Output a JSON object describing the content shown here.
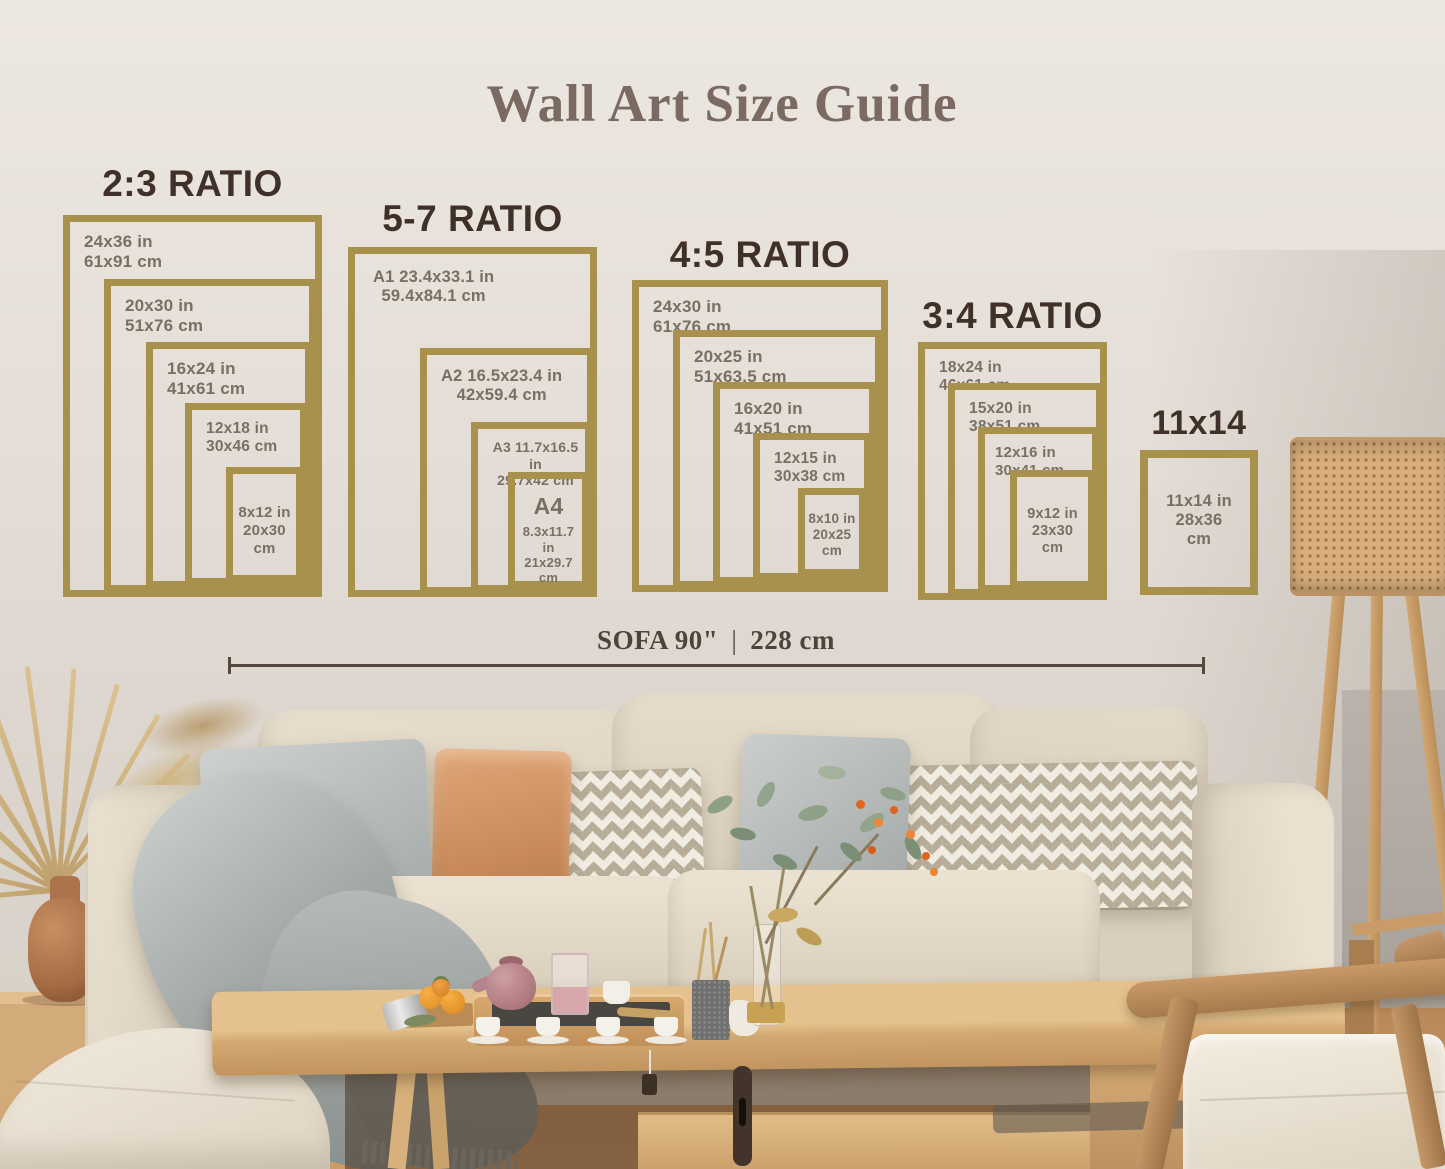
{
  "title": "Wall Art Size Guide",
  "groups": [
    {
      "heading": "2:3 RATIO",
      "frames": [
        {
          "in": "24x36 in",
          "cm": "61x91 cm"
        },
        {
          "in": "20x30 in",
          "cm": "51x76 cm"
        },
        {
          "in": "16x24 in",
          "cm": "41x61 cm"
        },
        {
          "in": "12x18 in",
          "cm": "30x46 cm"
        },
        {
          "in": "8x12 in",
          "cm": "20x30 cm"
        }
      ]
    },
    {
      "heading": "5-7 RATIO",
      "frames": [
        {
          "in": "A1 23.4x33.1 in",
          "cm": "59.4x84.1 cm"
        },
        {
          "in": "A2 16.5x23.4 in",
          "cm": "42x59.4 cm"
        },
        {
          "in": "A3 11.7x16.5 in",
          "cm": "29.7x42 cm"
        },
        {
          "name": "A4",
          "in": "8.3x11.7 in",
          "cm": "21x29.7 cm"
        }
      ]
    },
    {
      "heading": "4:5 RATIO",
      "frames": [
        {
          "in": "24x30 in",
          "cm": "61x76 cm"
        },
        {
          "in": "20x25 in",
          "cm": "51x63.5 cm"
        },
        {
          "in": "16x20 in",
          "cm": "41x51 cm"
        },
        {
          "in": "12x15 in",
          "cm": "30x38 cm"
        },
        {
          "in": "8x10 in",
          "cm": "20x25 cm"
        }
      ]
    },
    {
      "heading": "3:4 RATIO",
      "frames": [
        {
          "in": "18x24 in",
          "cm": "46x61 cm"
        },
        {
          "in": "15x20 in",
          "cm": "38x51 cm"
        },
        {
          "in": "12x16 in",
          "cm": "30x41 cm"
        },
        {
          "in": "9x12 in",
          "cm": "23x30 cm"
        }
      ]
    },
    {
      "heading": "11x14",
      "frames": [
        {
          "in": "11x14 in",
          "cm": "28x36 cm"
        }
      ]
    }
  ],
  "sofa_measure": {
    "label": "SOFA 90\"",
    "separator": "|",
    "value": "228 cm"
  },
  "colors": {
    "frame_gold": "#a8914d",
    "heading_brown": "#40302a",
    "label_gray": "#7a6f64",
    "title_brown": "#7b6a61",
    "measure_dark": "#55493f"
  }
}
